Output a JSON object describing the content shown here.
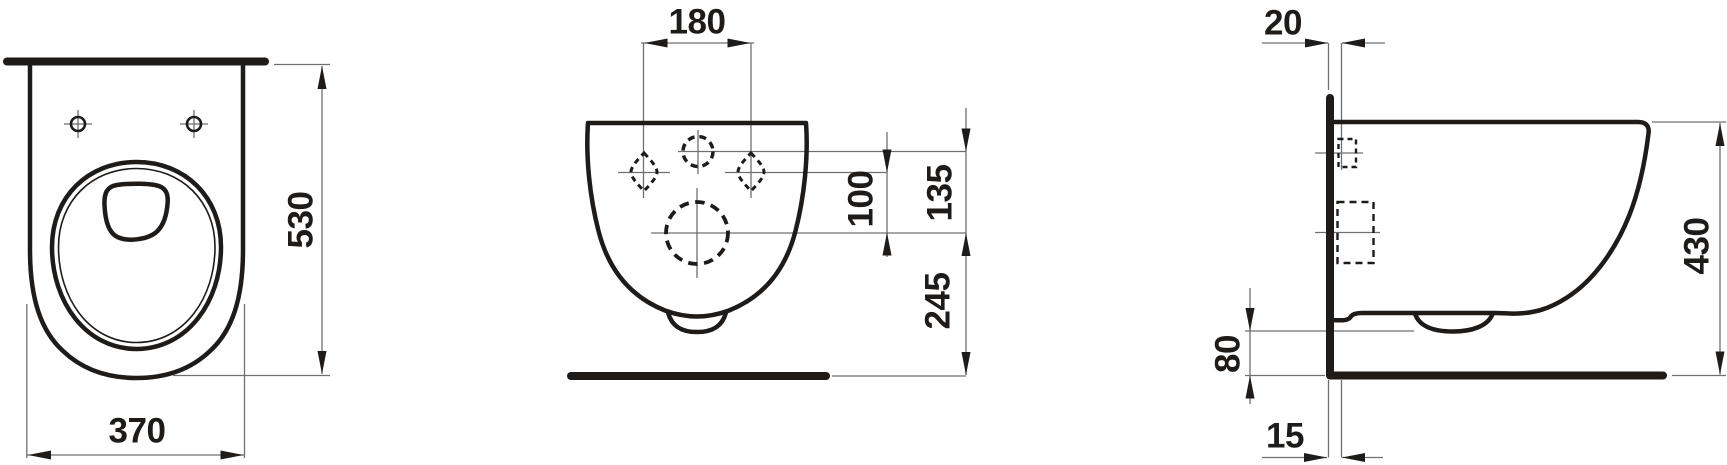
{
  "drawing": {
    "type": "sanitary-ware technical dimension drawing",
    "subject": "wall-hung WC, three orthographic views",
    "units_shown": "none (mm implied)",
    "colors": {
      "ink": "#1e1b19",
      "thin_line": "#6f6f6f",
      "background": "#ffffff"
    }
  },
  "dims": {
    "top_width": "370",
    "top_depth": "530",
    "rear_bolt_spacing": "180",
    "rear_bolt_to_outlet": "100",
    "rear_inlet_to_outlet": "135",
    "rear_outlet_to_floor": "245",
    "side_wall_gap_top": "20",
    "side_bottom_clearance": "80",
    "side_wall_gap_bottom": "15",
    "side_height": "430"
  }
}
